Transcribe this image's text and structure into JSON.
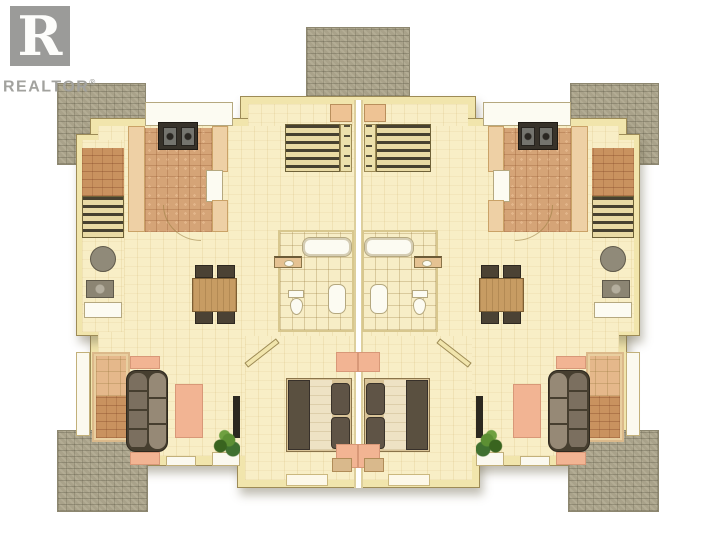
{
  "logo": {
    "brand": "REALTOR",
    "registered_mark": "®",
    "glyph": "R"
  },
  "palette": {
    "background": "#ffffff",
    "stone_patio": "#a9a28a",
    "wall_fill": "#f1e5ac",
    "wall_line": "#9d8b56",
    "wood_floor": "#f8eec6",
    "terracotta_tile": "#d5a477",
    "counter_peach": "#eed0a5",
    "rug_salmon": "#f2b493",
    "furniture_dark": "#584e3f",
    "sofa_taupe": "#867968",
    "table_wood": "#c79c63",
    "fixture_white": "#fcfbf2",
    "plant_green": "#4a7a30",
    "logo_gray": "#9b9b99"
  },
  "plan": {
    "type": "duplex-floor-plan",
    "mirrored": true,
    "units": [
      {
        "id": "left",
        "rooms": [
          "entry-stair-hall",
          "kitchen",
          "dining-area",
          "central-staircase",
          "bathroom",
          "living-room",
          "bedroom"
        ],
        "furniture": [
          "washer",
          "dryer",
          "stove",
          "refrigerator",
          "kitchen-counters",
          "dining-table",
          "four-chairs",
          "bathtub",
          "vanity-sink",
          "toilet",
          "pedestal-sink",
          "sofa",
          "area-rug",
          "fireplace",
          "tv",
          "potted-plant",
          "double-bed",
          "two-pillows"
        ]
      },
      {
        "id": "right",
        "rooms": [
          "entry-stair-hall",
          "kitchen",
          "dining-area",
          "central-staircase",
          "bathroom",
          "living-room",
          "bedroom"
        ],
        "furniture": [
          "washer",
          "dryer",
          "stove",
          "refrigerator",
          "kitchen-counters",
          "dining-table",
          "four-chairs",
          "bathtub",
          "vanity-sink",
          "toilet",
          "pedestal-sink",
          "sofa",
          "area-rug",
          "fireplace",
          "tv",
          "potted-plant",
          "double-bed",
          "two-pillows"
        ]
      }
    ],
    "exterior": [
      "front-stone-stoop",
      "upper-left-stone-patio",
      "upper-right-stone-patio",
      "lower-left-stone-patio",
      "lower-right-stone-patio"
    ]
  }
}
